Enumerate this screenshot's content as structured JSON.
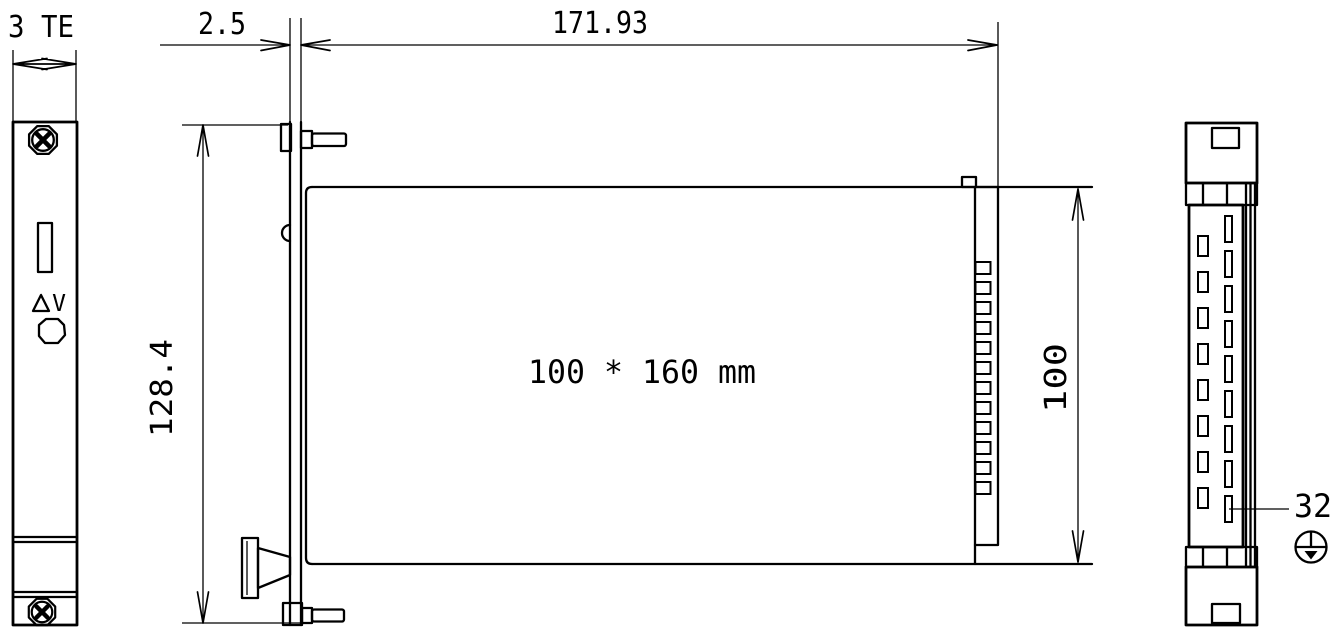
{
  "drawing": {
    "type": "engineering-dimension-drawing",
    "subject": "Eurocard plug-in module with front panel and 32-pin connector",
    "colors": {
      "line": "#000000",
      "background": "#ffffff"
    },
    "labels": {
      "front_width": "3 TE",
      "panel_thickness": "2.5",
      "module_depth": "171.93",
      "panel_height": "128.4",
      "board_size": "100 * 160 mm",
      "board_height": "100",
      "pin_count": "32",
      "voltage_symbol": "V"
    },
    "icons": {
      "delta_symbol": "triangle-outline",
      "earth_ground": "protective-earth-circle",
      "front_screw": "phillips-collar-screw",
      "side_screw": "knurled-screw-shaft",
      "rear_screw": "knurled-screw-head",
      "led_slot": "front-panel-slot",
      "button": "front-panel-button",
      "handle": "extractor-handle"
    },
    "counts": {
      "side_connector_teeth": 12,
      "rear_left_pins": 8,
      "rear_right_pins": 9
    }
  }
}
